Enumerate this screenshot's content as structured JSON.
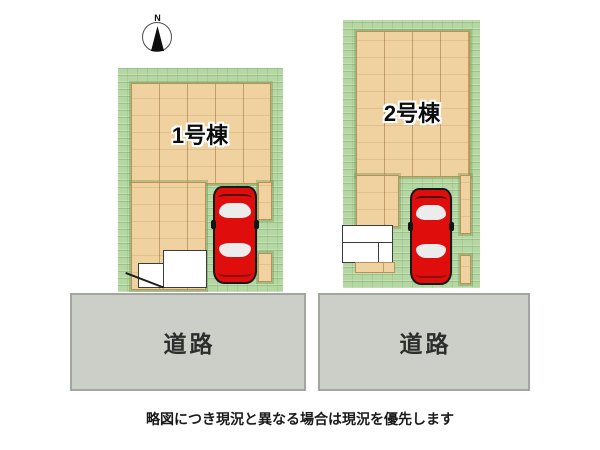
{
  "compass": {
    "label": "N",
    "icon": "compass-north-icon"
  },
  "lots": [
    {
      "label": "1号棟",
      "car_icon": "car-top-view-icon"
    },
    {
      "label": "2号棟",
      "car_icon": "car-top-view-icon"
    }
  ],
  "roads": [
    {
      "label": "道路"
    },
    {
      "label": "道路"
    }
  ],
  "caption": "略図につき現況と異なる場合は現況を優先します",
  "colors": {
    "lawn_green": "#b5d7a3",
    "wood_tan": "#f0d2a1",
    "road_gray": "#cbcfc8",
    "car_red": "#e00d0d",
    "outline_black": "#181818"
  }
}
